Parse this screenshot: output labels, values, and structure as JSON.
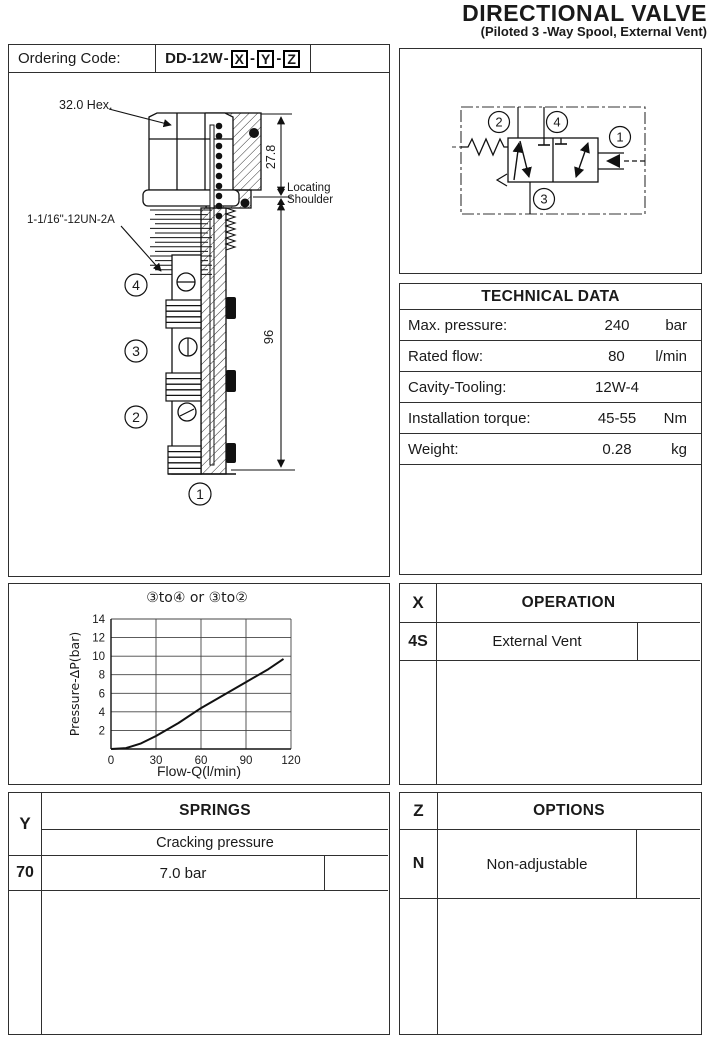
{
  "header": {
    "title": "DIRECTIONAL VALVE",
    "subtitle": "(Piloted 3 -Way Spool, External Vent)"
  },
  "ordering": {
    "label": "Ordering Code:",
    "code_prefix": "DD-12W",
    "separator": "-",
    "code_x": "X",
    "code_y": "Y",
    "code_z": "Z"
  },
  "drawing": {
    "hex_label": "32.0 Hex.",
    "thread_label": "1-1/16\"-12UN-2A",
    "dim_upper": "27.8",
    "dim_overall": "96",
    "locating_line1": "Locating",
    "locating_line2": "Shoulder",
    "unit_label": "UNIT:mm",
    "port_markers": {
      "p4": "4",
      "p3": "3",
      "p2": "2",
      "p1": "1"
    }
  },
  "schematic": {
    "port_top_left": "2",
    "port_top_center": "4",
    "port_right": "1",
    "port_bottom": "3"
  },
  "technical_data": {
    "title": "TECHNICAL DATA",
    "rows": [
      {
        "label": "Max. pressure:",
        "value": "240",
        "unit": "bar"
      },
      {
        "label": "Rated flow:",
        "value": "80",
        "unit": "l/min"
      },
      {
        "label": "Cavity-Tooling:",
        "value": "12W-4",
        "unit": ""
      },
      {
        "label": "Installation torque:",
        "value": "45-55",
        "unit": "Nm"
      },
      {
        "label": "Weight:",
        "value": "0.28",
        "unit": "kg"
      }
    ]
  },
  "operation_table": {
    "code": "X",
    "title": "OPERATION",
    "rows": [
      {
        "code": "4S",
        "label": "External Vent"
      }
    ]
  },
  "springs_table": {
    "code": "Y",
    "title": "SPRINGS",
    "subtitle": "Cracking pressure",
    "rows": [
      {
        "code": "70",
        "label": "7.0 bar"
      }
    ]
  },
  "options_table": {
    "code": "Z",
    "title": "OPTIONS",
    "rows": [
      {
        "code": "N",
        "label": "Non-adjustable"
      }
    ]
  },
  "chart_data": {
    "type": "line",
    "title": "③to④ or ③to②",
    "xlabel": "Flow-Q(l/min)",
    "ylabel": "Pressure-ΔP(bar)",
    "xlim": [
      0,
      120
    ],
    "ylim": [
      0,
      14
    ],
    "xticks": [
      0,
      30,
      60,
      90,
      120
    ],
    "yticks": [
      2,
      4,
      6,
      8,
      10,
      12,
      14
    ],
    "grid": true,
    "legend": "none",
    "series": [
      {
        "name": "pressure drop 3-to-4 or 3-to-2",
        "points": [
          [
            0,
            0
          ],
          [
            10,
            0.1
          ],
          [
            20,
            0.6
          ],
          [
            30,
            1.4
          ],
          [
            45,
            2.8
          ],
          [
            60,
            4.4
          ],
          [
            75,
            5.8
          ],
          [
            90,
            7.2
          ],
          [
            105,
            8.6
          ],
          [
            115,
            9.7
          ]
        ]
      }
    ]
  },
  "colors": {
    "ink": "#1a1a1a",
    "border": "#2f2f2f",
    "background": "#ffffff"
  }
}
